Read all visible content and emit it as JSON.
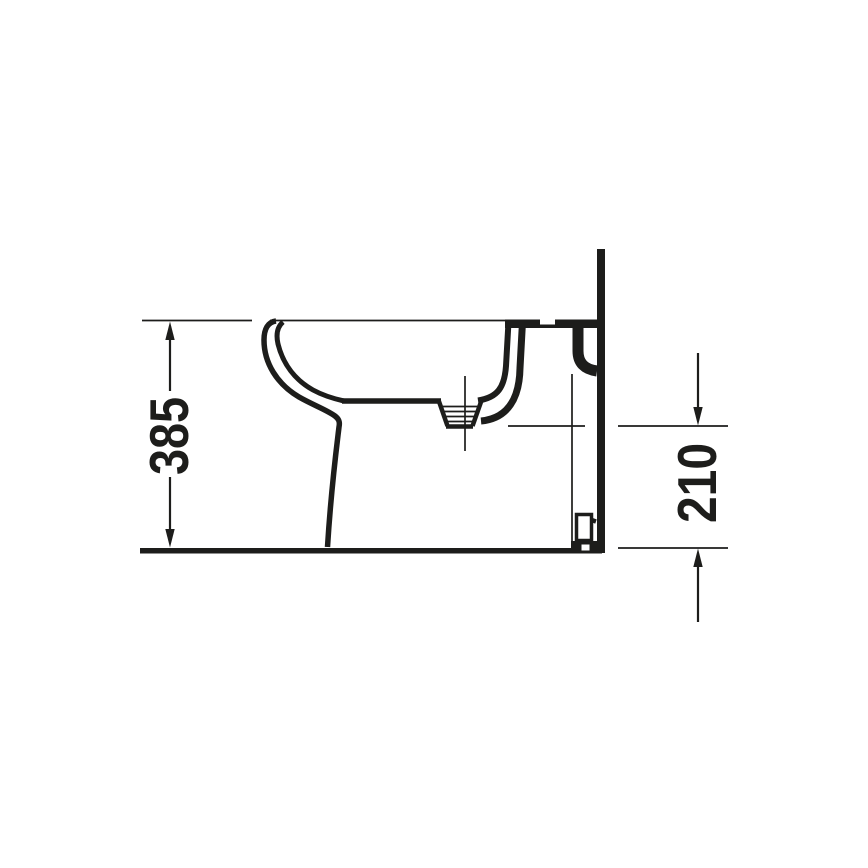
{
  "drawing": {
    "subject": "floor-standing-bidet-side-elevation",
    "ink_color": "#1d1d1b",
    "background_color": "#ffffff",
    "dimensions": {
      "left": {
        "label": "385",
        "orientation": "vertical",
        "from": "floor-line",
        "to": "rim-top-line"
      },
      "right": {
        "label": "210",
        "orientation": "vertical",
        "from": "floor-line",
        "to": "outlet-centerline"
      }
    }
  }
}
